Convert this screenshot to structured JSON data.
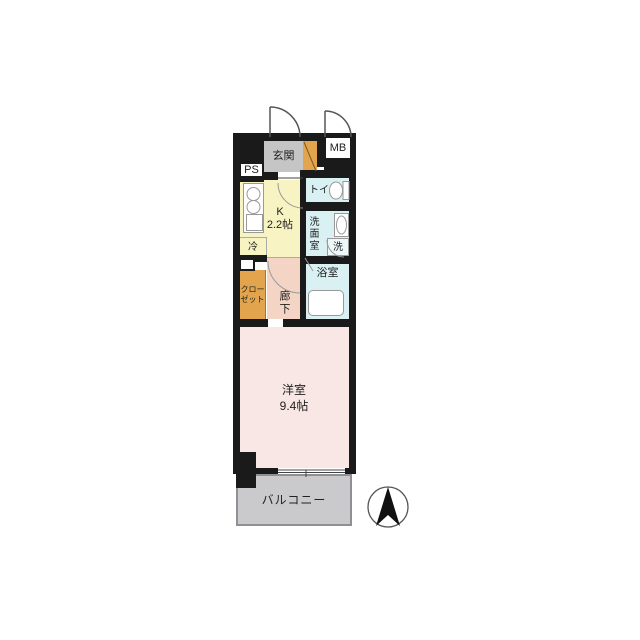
{
  "labels": {
    "entrance": "玄関",
    "meter_box": "MB",
    "pipe_space": "PS",
    "kitchen_name": "K",
    "kitchen_size": "2.2帖",
    "fridge": "冷",
    "toilet": "トイレ",
    "washroom": "洗面室",
    "washer": "洗",
    "bathroom": "浴室",
    "closet_line1": "クロー",
    "closet_line2": "ゼット",
    "hallway": "廊下",
    "main_room_name": "洋室",
    "main_room_size": "9.4帖",
    "balcony": "バルコニー"
  },
  "colors": {
    "wall": "#1a1a1a",
    "entrance_floor": "#c5c5c5",
    "wood": "#e2a54d",
    "kitchen_floor": "#f7f3c2",
    "wet_area": "#daf1f3",
    "hallway_floor": "#f4d5c5",
    "room_floor": "#f8e7e4",
    "balcony_floor": "#cacacd",
    "line": "#999999"
  }
}
